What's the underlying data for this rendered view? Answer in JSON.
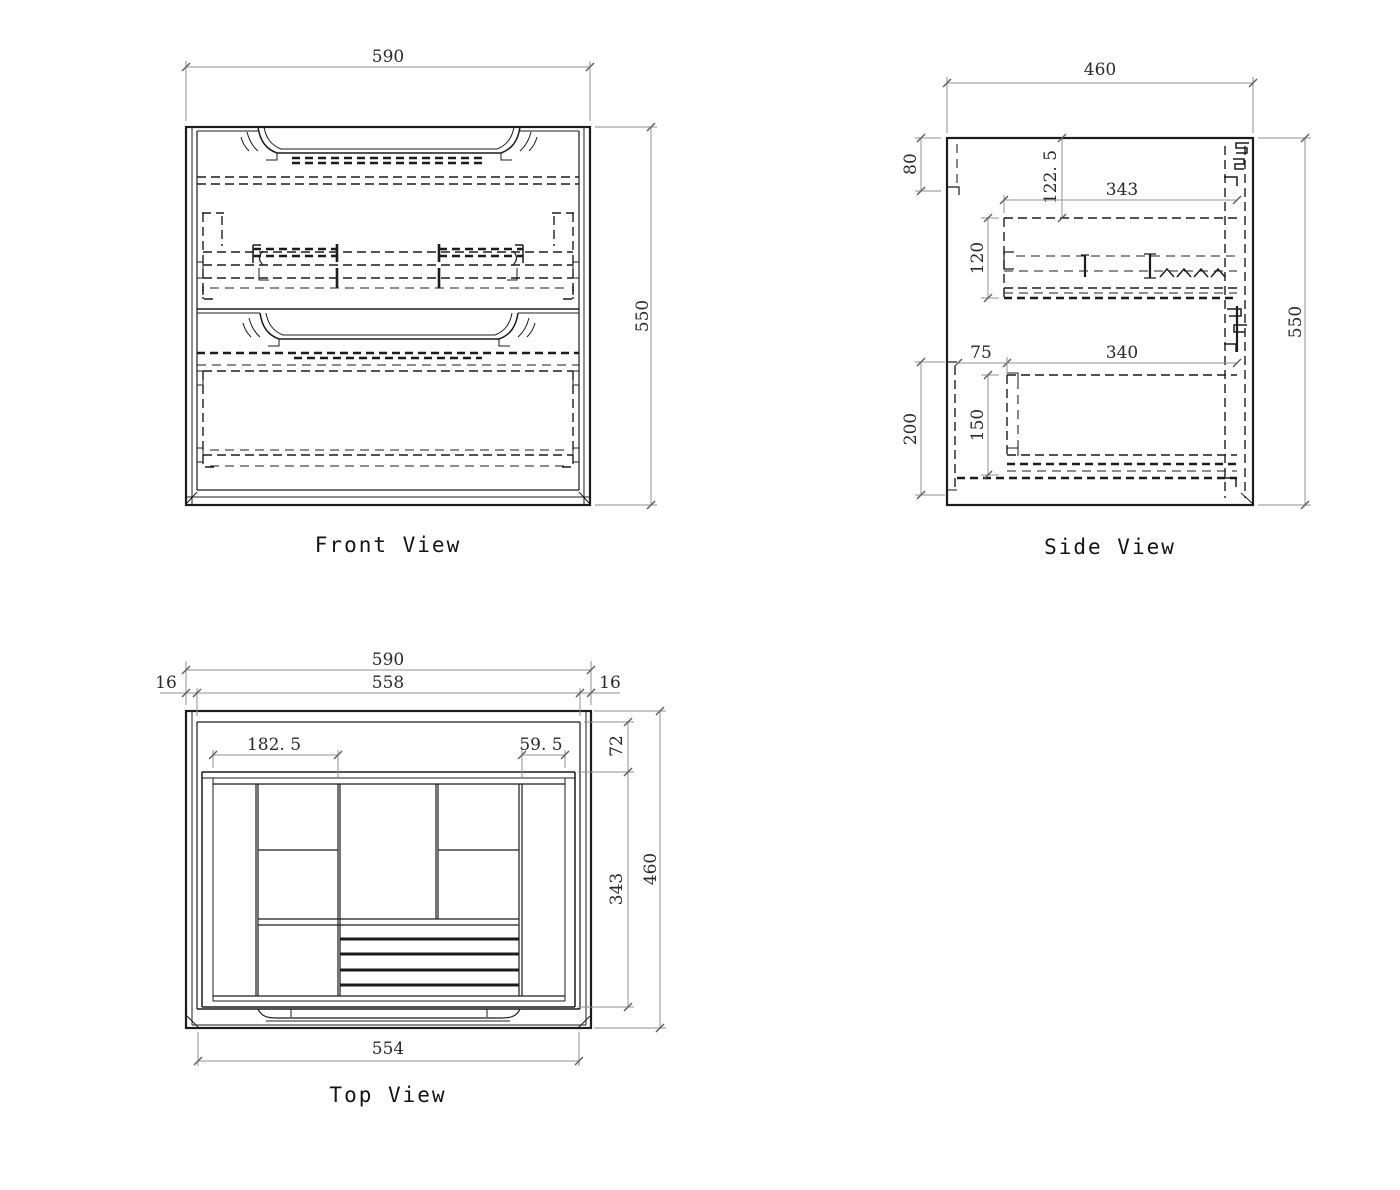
{
  "sheet": {
    "background": "#ffffff",
    "line_color": "#1c1c1c",
    "dim_line_color": "#919191",
    "dim_text_color": "#2a2a2a"
  },
  "views": {
    "front": {
      "label": "Front View",
      "dims": {
        "width": "590",
        "height": "550"
      }
    },
    "side": {
      "label": "Side View",
      "dims": {
        "width": "460",
        "height": "550",
        "back_notch": "80",
        "drawer1_offset": "122. 5",
        "drawer1_depth": "343",
        "drawer1_height": "120",
        "front_gap": "75",
        "drawer2_depth": "340",
        "lower_zone": "200",
        "drawer2_height": "150"
      }
    },
    "top": {
      "label": "Top View",
      "dims": {
        "width": "590",
        "inner_width": "558",
        "wall_left": "16",
        "wall_right": "16",
        "tray_left": "182. 5",
        "tray_right": "59. 5",
        "back_gap": "72",
        "tray_depth": "343",
        "depth": "460",
        "front_width": "554"
      }
    }
  }
}
